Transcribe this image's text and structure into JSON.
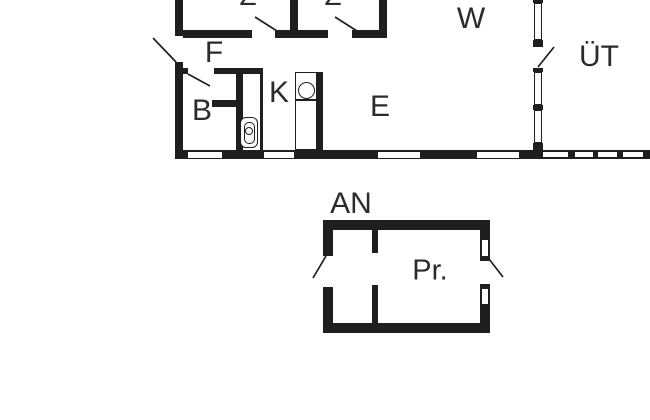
{
  "colors": {
    "wall": "#1f1f1f",
    "text": "#2b2b2b",
    "background": "#ffffff"
  },
  "floor_plan": {
    "main_building": {
      "room_labels": {
        "z1": "Z",
        "z2": "Z",
        "f": "F",
        "b": "B",
        "k": "K",
        "e": "E",
        "w": "W",
        "ut": "ÜT"
      }
    },
    "annex": {
      "label": "AN",
      "room_labels": {
        "pr": "Pr."
      }
    }
  }
}
